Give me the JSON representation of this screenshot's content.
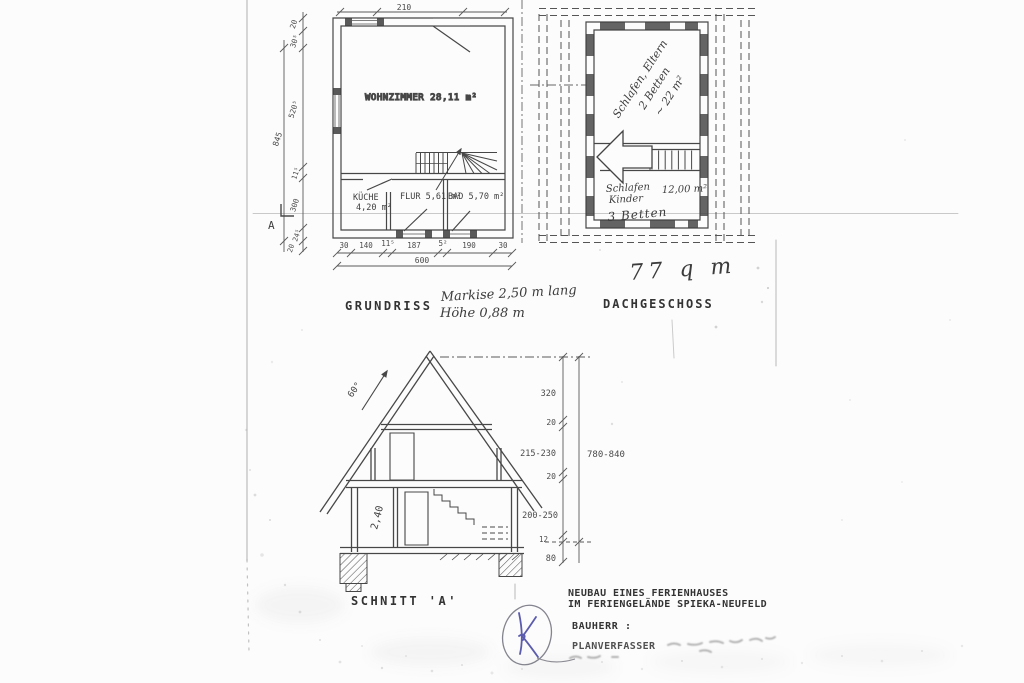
{
  "sheet": {
    "total_area_note": "77 q m",
    "markise_note_line1": "Markise 2,50 m lang",
    "markise_note_line2": "Höhe  0,88 m"
  },
  "ground_plan": {
    "title": "GRUNDRISS",
    "rooms": {
      "wohnzimmer": "WOHNZIMMER 28,11 m²",
      "kueche_name": "KÜCHE",
      "kueche_area": "4,20 m²",
      "flur": "FLUR 5,61 m²",
      "bad": "BAD 5,70 m²"
    },
    "dims": {
      "top": "210",
      "bottom_segments": [
        "30",
        "140",
        "11⁵",
        "187",
        "5²",
        "190",
        "30"
      ],
      "bottom_total": "600",
      "left_segments": [
        "20",
        "30⁵",
        "520⁵",
        "11⁵",
        "300",
        "24⁵",
        "20"
      ],
      "left_total": "845",
      "section_marker": "A"
    }
  },
  "attic_plan": {
    "title": "DACHGESCHOSS",
    "parents_room": {
      "line1": "Schlafen, Eltern",
      "line2": "2 Betten",
      "line3": "~ 22 m²"
    },
    "kids_room": {
      "line1": "Schlafen",
      "line2": "Kinder",
      "beds": "3 Betten",
      "area": "12,00 m²"
    }
  },
  "section": {
    "title": "SCHNITT 'A'",
    "roof_angle": "60°",
    "room_height": "2,40",
    "dim_segments": [
      "320",
      "20",
      "215-230",
      "20",
      "200-250",
      "12",
      "80"
    ],
    "dim_total": "780-840"
  },
  "title_block": {
    "line1": "NEUBAU EINES FERIENHAUSES",
    "line2": "IM FERIENGELÄNDE SPIEKA-NEUFELD",
    "bauherr": "BAUHERR :",
    "planverfasser": "PLANVERFASSER"
  },
  "stamp": {
    "initial": "K"
  }
}
